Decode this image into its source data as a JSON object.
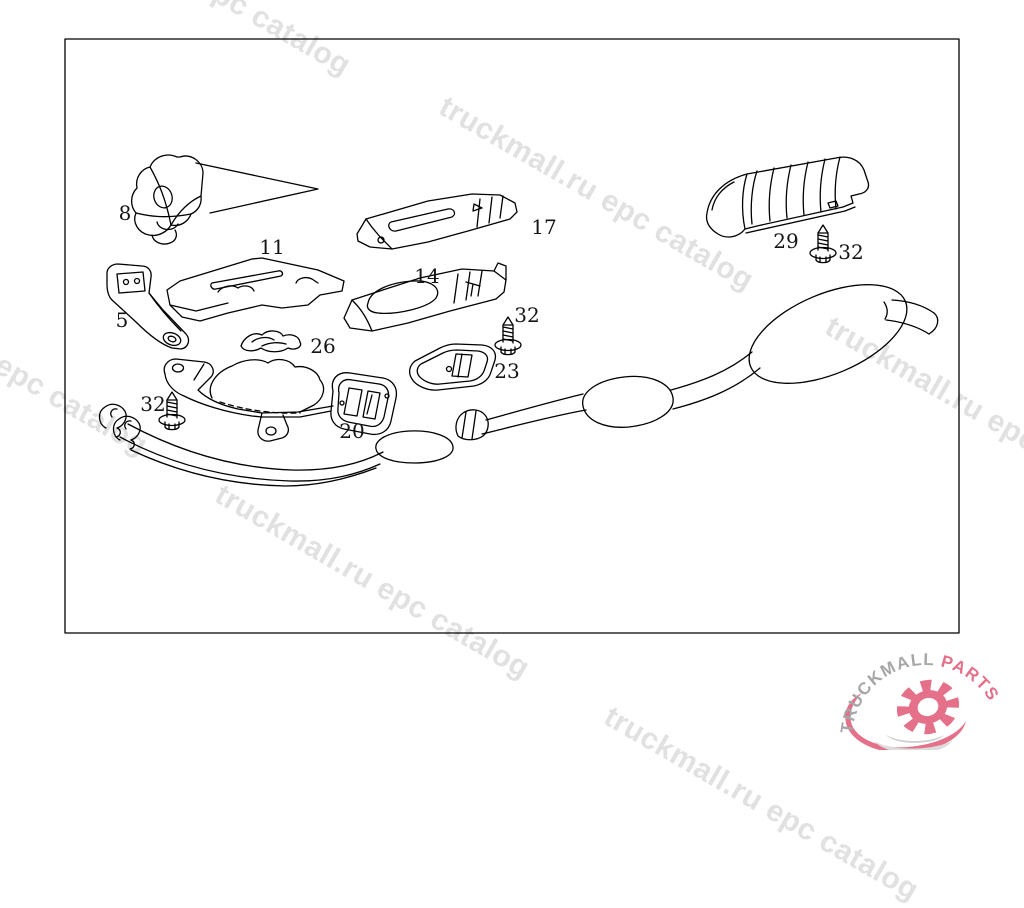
{
  "watermark": {
    "text": "truckmall.ru epc catalog",
    "color": "#e1e1e1"
  },
  "logo": {
    "brand_part1": "TRUCKMALL",
    "brand_part2": "PARTS",
    "color_gray": "#a6a6a6",
    "color_pink": "#e4708a"
  },
  "diagram": {
    "line_color": "#000000",
    "labels": [
      {
        "text": "8"
      },
      {
        "text": "11"
      },
      {
        "text": "5"
      },
      {
        "text": "26"
      },
      {
        "text": "17"
      },
      {
        "text": "14"
      },
      {
        "text": "32"
      },
      {
        "text": "23"
      },
      {
        "text": "29"
      },
      {
        "text": "32"
      },
      {
        "text": "32"
      },
      {
        "text": "20"
      }
    ]
  }
}
